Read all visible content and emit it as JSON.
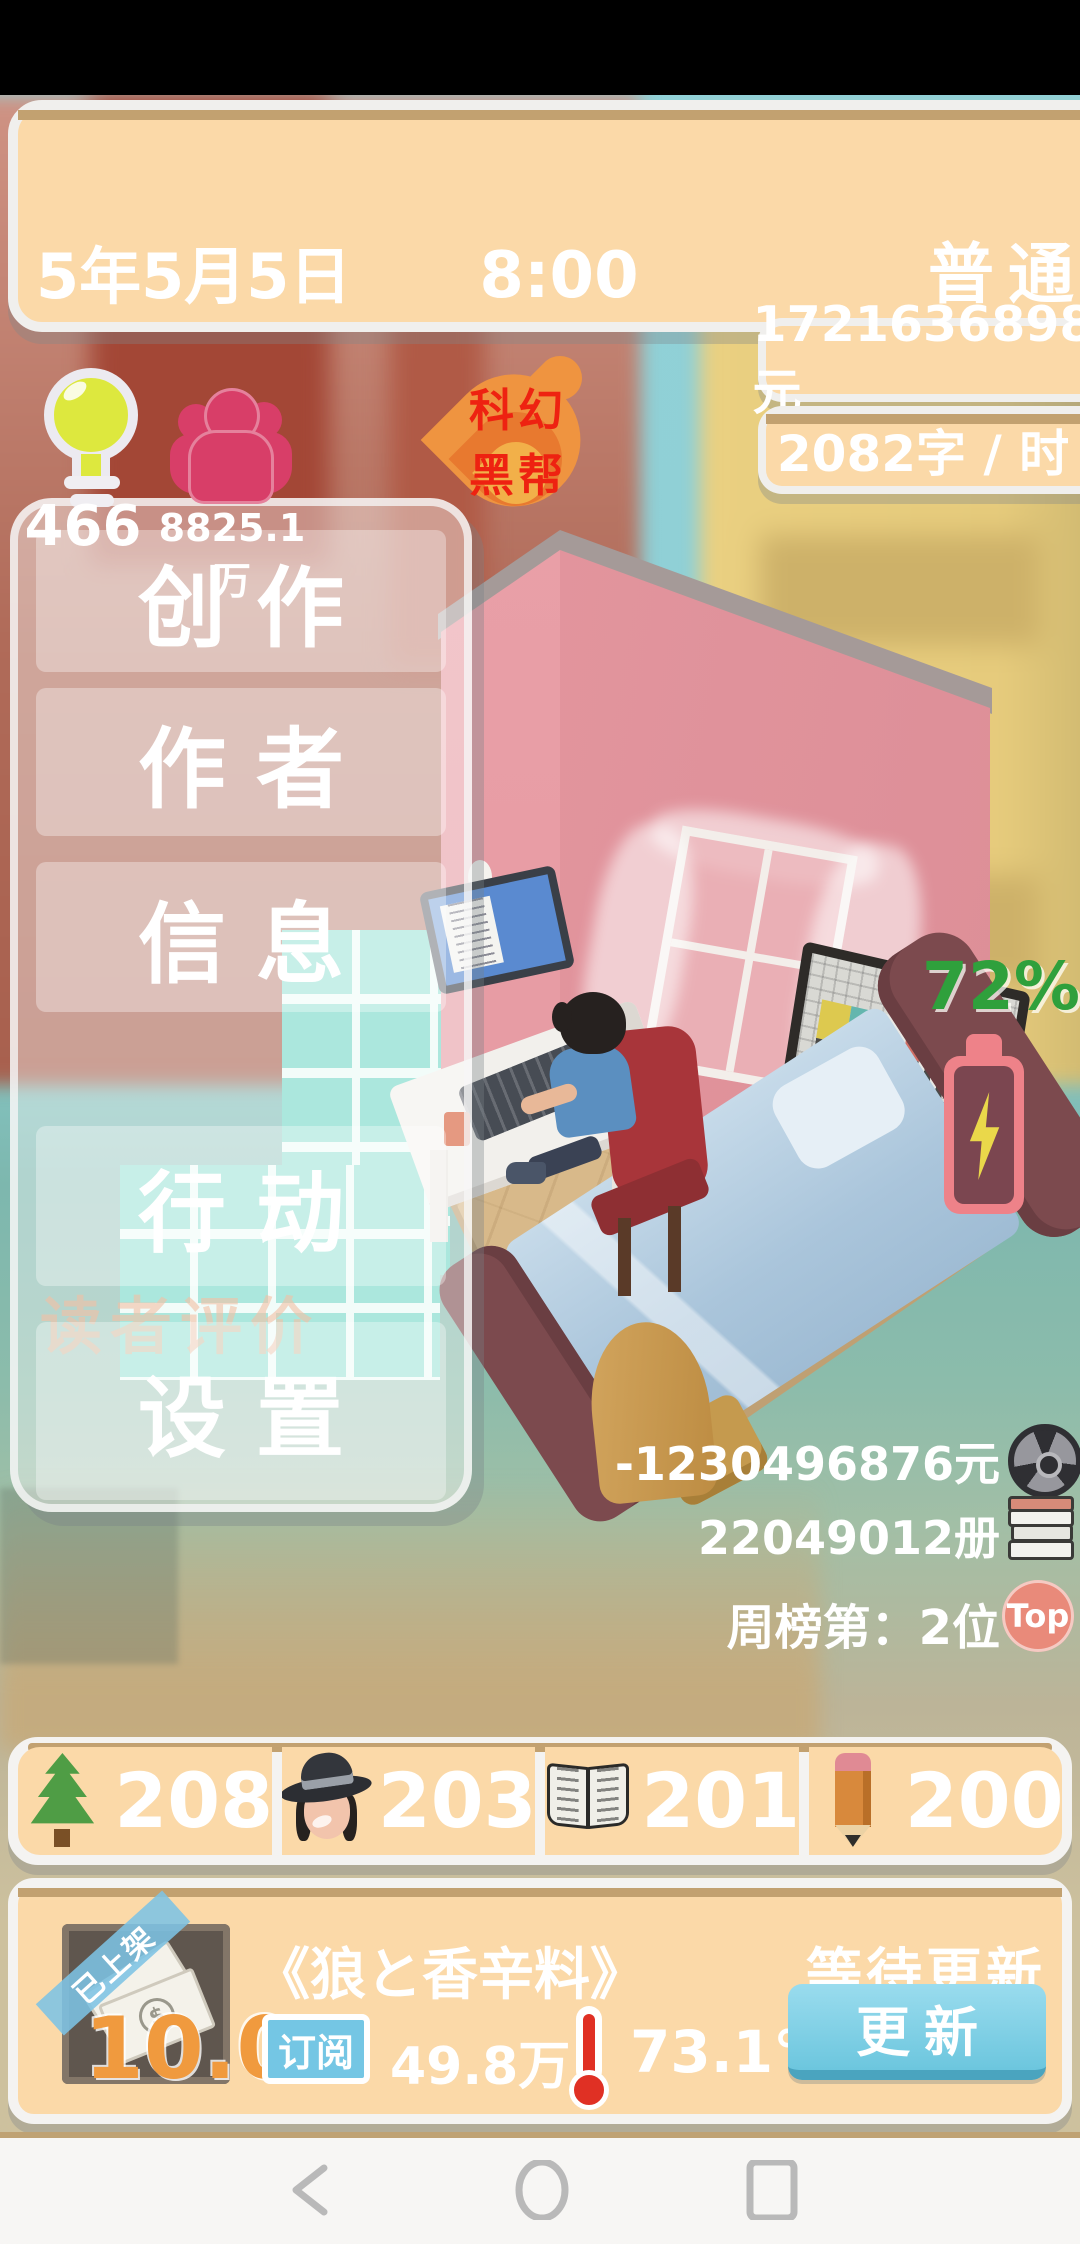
{
  "hud": {
    "date": "5年5月5日",
    "time": "8:00",
    "difficulty": "普通",
    "money": "1721636898元",
    "write_speed": "2082字 / 时",
    "inspiration": "466",
    "fans": "8825.1万",
    "genre_line1": "科幻",
    "genre_line2": "黑帮",
    "battery_percent": "72%",
    "stats": {
      "adaptation_money": "-1230496876元",
      "copies_sold": "22049012册",
      "week_rank": "周榜第：2位",
      "rank_badge": "Top"
    }
  },
  "menu": {
    "items": [
      {
        "label": "创作"
      },
      {
        "label": "作者"
      },
      {
        "label": "信息"
      },
      {
        "label": "行动"
      },
      {
        "label": "设置"
      }
    ],
    "background_button": "读者评价"
  },
  "resources": {
    "items": [
      {
        "icon": "tree-icon",
        "value": "208"
      },
      {
        "icon": "hat-icon",
        "value": "203"
      },
      {
        "icon": "open-book-icon",
        "value": "201"
      },
      {
        "icon": "pencil-icon",
        "value": "200"
      }
    ]
  },
  "current_book": {
    "ribbon": "已上架",
    "price": "10.0",
    "cover_symbol": "$",
    "title": "《狼と香辛料》",
    "status": "等待更新",
    "subscribe_label": "订阅",
    "subscribers": "49.8万",
    "heat": "73.1°",
    "update_button": "更新"
  },
  "colors": {
    "panel_peach": "#fbd9a8",
    "panel_stripe_tan": "#c2a170",
    "battery_green": "#2fa03c",
    "genre_red": "#ee2211",
    "accent_blue": "#74c6e4",
    "price_orange": "#f09a3e",
    "fans_pink": "#d83e68"
  }
}
